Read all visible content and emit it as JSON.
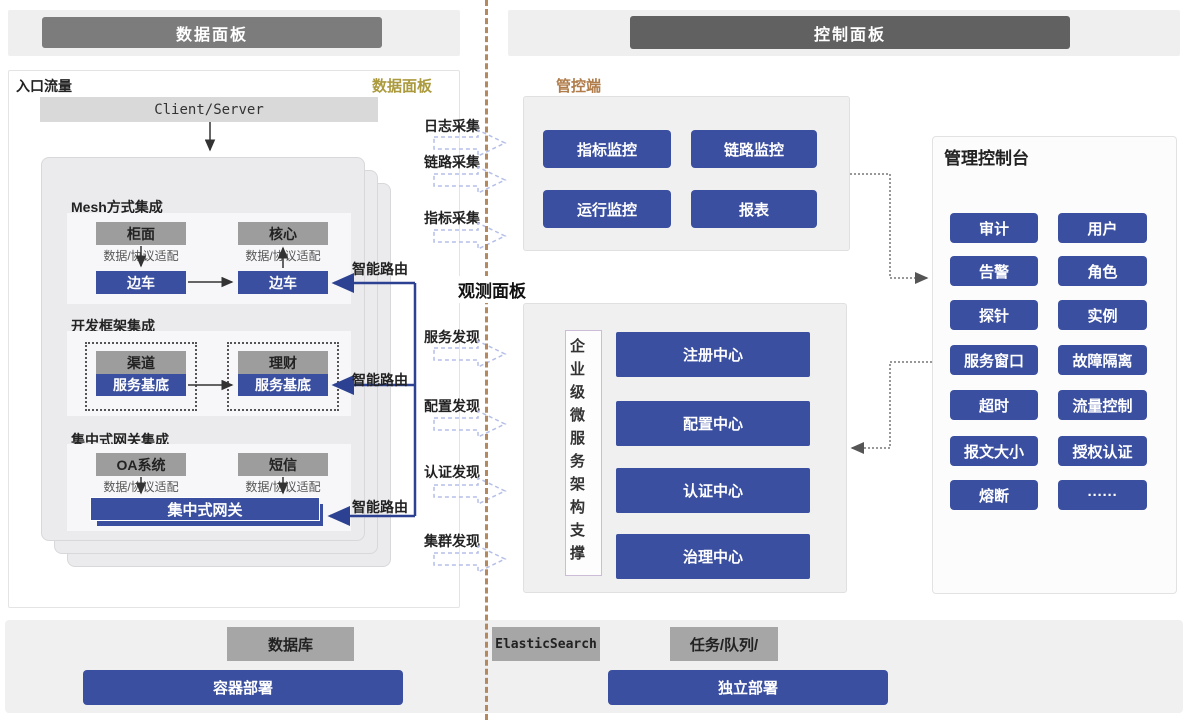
{
  "headers": {
    "left": "数据面板",
    "right": "控制面板"
  },
  "data_panel": {
    "corner_label": "入口流量",
    "panel_label": "数据面板",
    "client_server": "Client/Server",
    "sections": [
      {
        "title": "Mesh方式集成",
        "left_app": "柜面",
        "right_app": "核心",
        "adapter": "数据/协议适配",
        "left_proxy": "边车",
        "right_proxy": "边车",
        "route_label": "智能路由"
      },
      {
        "title": "开发框架集成",
        "left_app": "渠道",
        "right_app": "理财",
        "left_proxy": "服务基底",
        "right_proxy": "服务基底",
        "route_label": "智能路由"
      },
      {
        "title": "集中式网关集成",
        "left_app": "OA系统",
        "right_app": "短信",
        "adapter": "数据/协议适配",
        "gateway": "集中式网关",
        "route_label": "智能路由"
      }
    ]
  },
  "flows": {
    "collect": [
      "日志采集",
      "链路采集",
      "指标采集"
    ],
    "discover": [
      "服务发现",
      "配置发现",
      "认证发现",
      "集群发现"
    ]
  },
  "observe_label": "观测面板",
  "control_panel": {
    "label": "管控端",
    "buttons": [
      "指标监控",
      "链路监控",
      "运行监控",
      "报表"
    ]
  },
  "observe_panel": {
    "support_label": "企业级微服务架构支撑",
    "centers": [
      "注册中心",
      "配置中心",
      "认证中心",
      "治理中心"
    ]
  },
  "console": {
    "title": "管理控制台",
    "buttons": [
      "审计",
      "用户",
      "告警",
      "角色",
      "探针",
      "实例",
      "服务窗口",
      "故障隔离",
      "超时",
      "流量控制",
      "报文大小",
      "授权认证",
      "熔断",
      "······"
    ]
  },
  "bottom": {
    "gray": [
      "数据库",
      "ElasticSearch",
      "任务/队列/"
    ],
    "blue": [
      "容器部署",
      "独立部署"
    ]
  },
  "colors": {
    "blue": "#3a4f9f",
    "gold": "#ab9a3e",
    "brown": "#b07c4a",
    "divider": "#b5895f"
  }
}
